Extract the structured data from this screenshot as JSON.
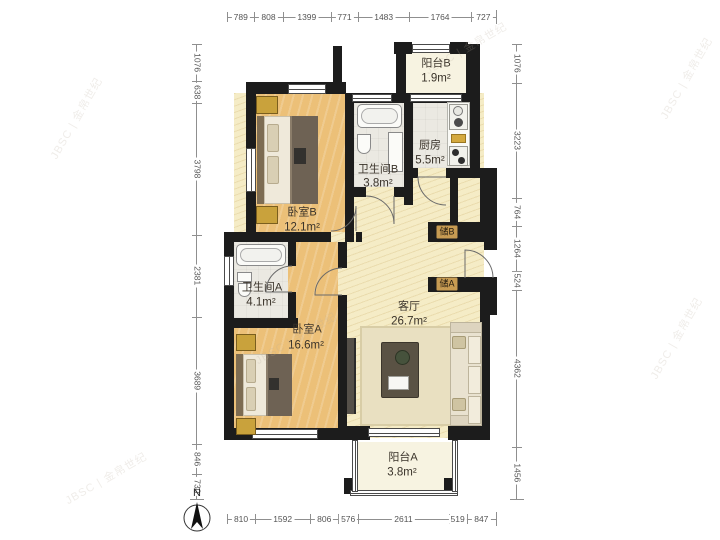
{
  "plan": {
    "rooms": [
      {
        "id": "balcony-b",
        "name": "阳台B",
        "area": "1.9m²"
      },
      {
        "id": "kitchen",
        "name": "厨房",
        "area": "5.5m²"
      },
      {
        "id": "bath-b",
        "name": "卫生间B",
        "area": "3.8m²"
      },
      {
        "id": "bed-b",
        "name": "卧室B",
        "area": "12.1m²"
      },
      {
        "id": "bath-a",
        "name": "卫生间A",
        "area": "4.1m²"
      },
      {
        "id": "bed-a",
        "name": "卧室A",
        "area": "16.6m²"
      },
      {
        "id": "living",
        "name": "客厅",
        "area": "26.7m²"
      },
      {
        "id": "balcony-a",
        "name": "阳台A",
        "area": "3.8m²"
      },
      {
        "id": "storage-b",
        "name": "储B"
      },
      {
        "id": "storage-a",
        "name": "储A"
      }
    ],
    "compass_label": "N",
    "watermark": "JBSC | 金帛世纪"
  },
  "dimensions": {
    "top": [
      789,
      808,
      1399,
      771,
      1483,
      1764,
      727
    ],
    "bottom": [
      810,
      1592,
      806,
      576,
      2611,
      519,
      847
    ],
    "left": [
      1076,
      638,
      3798,
      2381,
      3689,
      846,
      730
    ],
    "right": [
      1076,
      3223,
      764,
      1264,
      524,
      4362,
      1456
    ]
  },
  "colors": {
    "wall": "#1c1c1c",
    "wood_floor": "#ecc078",
    "hall_floor": "#f5ecc6",
    "tile_floor": "#ebe9e2",
    "storage_tag": "#c79b52"
  }
}
